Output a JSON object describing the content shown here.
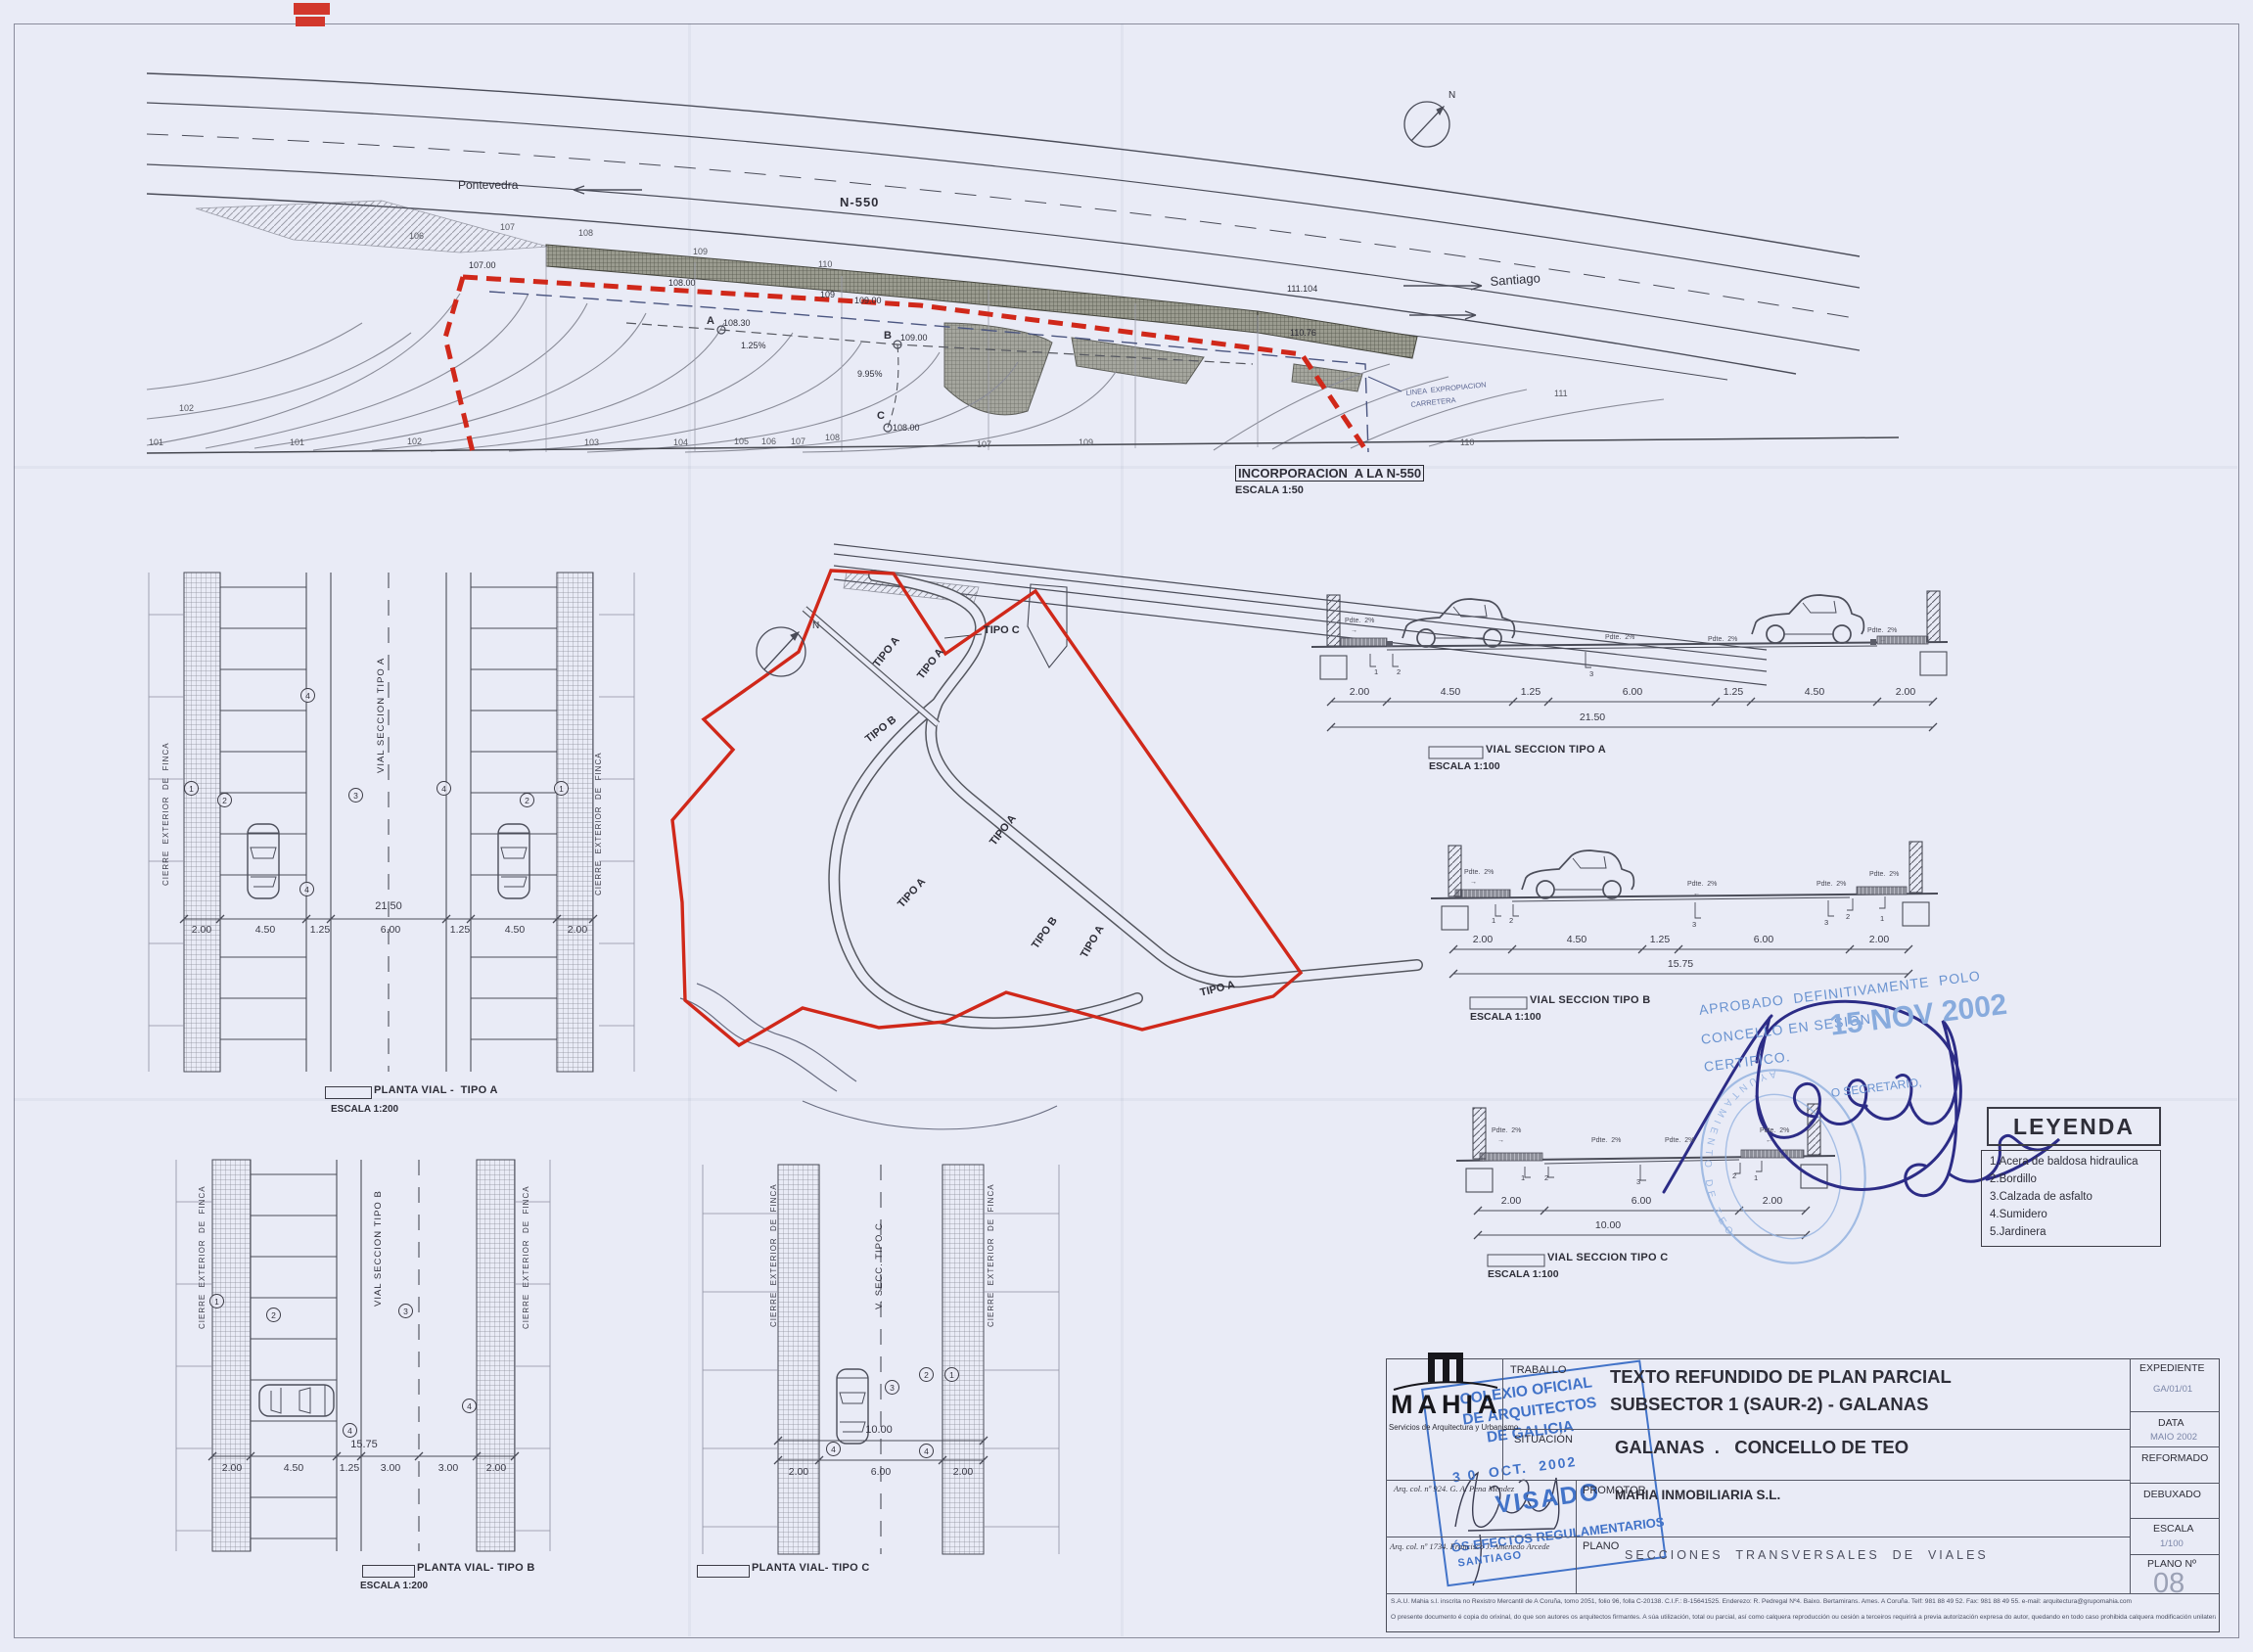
{
  "top_plan": {
    "title": "INCORPORACION  A LA N-550",
    "scale": "ESCALA 1:50",
    "dir_left": "Pontevedra",
    "dir_right": "Santiago",
    "road_name": "N-550",
    "expro_line1": "LINEA  EXPROPIACION",
    "expro_line2": "CARRETERA",
    "north": "N",
    "point_a": "A",
    "elev_a": "108.30",
    "point_b": "B",
    "elev_b": "109.00",
    "point_c": "C",
    "elev_c": "108.00",
    "slope_1": "1.25%",
    "slope_2": "9.95%",
    "spot_1": "111.104",
    "spot_2": "110.76",
    "red_elevs": [
      "107.00",
      "108.00",
      "109",
      "109.00"
    ],
    "contours_bottom": [
      "101",
      "102",
      "101",
      "102",
      "103",
      "104",
      "105",
      "106",
      "107",
      "108",
      "109",
      "107",
      "110"
    ],
    "contours_top": [
      "106",
      "107",
      "108",
      "109",
      "110",
      "111"
    ]
  },
  "site_plan": {
    "north": "N",
    "tipo_labels": [
      "TIPO C",
      "TIPO A",
      "TIPO A",
      "TIPO B",
      "TIPO A",
      "TIPO A",
      "TIPO B",
      "TIPO A",
      "TIPO A"
    ]
  },
  "plantas": {
    "fence_label": "CIERRE  EXTERIOR  DE  FINCA",
    "callouts": [
      "1",
      "2",
      "3",
      "4"
    ],
    "a": {
      "title": "PLANTA VIAL -  TIPO A",
      "scale": "ESCALA 1:200",
      "axis_label": "VIAL SECCION TIPO A",
      "dims": [
        "2.00",
        "4.50",
        "1.25",
        "6.00",
        "1.25",
        "4.50",
        "2.00"
      ],
      "total": "21.50"
    },
    "b": {
      "title": "PLANTA VIAL- TIPO B",
      "scale": "ESCALA 1:200",
      "axis_label": "VIAL SECCION TIPO B",
      "dims": [
        "2.00",
        "4.50",
        "1.25",
        "3.00",
        "3.00",
        "2.00"
      ],
      "total": "15.75"
    },
    "c": {
      "title": "PLANTA VIAL- TIPO C",
      "axis_label": "V. SECC. TIPO C",
      "dims": [
        "2.00",
        "6.00",
        "2.00"
      ],
      "total": "10.00"
    }
  },
  "sections": {
    "slope_label": "Pdte.  2%",
    "markers": [
      "1",
      "2",
      "3"
    ],
    "a": {
      "title": "VIAL SECCION TIPO A",
      "scale": "ESCALA 1:100",
      "dims": [
        "2.00",
        "4.50",
        "1.25",
        "6.00",
        "1.25",
        "4.50",
        "2.00"
      ],
      "total": "21.50"
    },
    "b": {
      "title": "VIAL SECCION TIPO B",
      "scale": "ESCALA 1:100",
      "dims": [
        "2.00",
        "4.50",
        "1.25",
        "6.00",
        "2.00"
      ],
      "total": "15.75"
    },
    "c": {
      "title": "VIAL SECCION TIPO C",
      "scale": "ESCALA 1:100",
      "dims": [
        "2.00",
        "6.00",
        "2.00"
      ],
      "total": "10.00"
    }
  },
  "legend": {
    "title": "LEYENDA",
    "items": [
      "1.Acera de baldosa hidraulica",
      "2.Bordillo",
      "3.Calzada de asfalto",
      "4.Sumidero",
      "5.Jardinera"
    ]
  },
  "stamps": {
    "approval": {
      "line1": "APROBADO  DEFINITIVAMENTE  POLO",
      "line2": "CONCELLO EN SESIÓN",
      "date": "15 NOV 2002",
      "line3": "CERTIFICO.",
      "line4": "O SECRETARIO,",
      "round_text": "AYUNTAMIENTO  DE  TEO"
    },
    "visado": {
      "line1": "COLEXIO OFICIAL",
      "line2": "DE ARQUITECTOS",
      "line3": "DE GALICIA",
      "date": "3 0  OCT.  2002",
      "word": "VISADO",
      "city": "SANTIAGO",
      "footer": "ÓS EFECTOS REGULAMENTARIOS"
    }
  },
  "title_block": {
    "logo": "MAHIA",
    "logo_sub": "Servicios de Arquitectura y Urbanismo",
    "arch1": "Arq. col. nº 924. G. A. Pena Mendez",
    "arch2": "Arq. col. nº 1734. Francisco J. Amenedo Arcede",
    "traballo_label": "TRABALLO",
    "traballo_line1": "TEXTO REFUNDIDO DE PLAN PARCIAL",
    "traballo_line2": "SUBSECTOR 1 (SAUR-2) - GALANAS",
    "situacion_label": "SITUACIÓN",
    "situacion_value": "GALANAS  .   CONCELLO DE TEO",
    "promotor_label": "PROMOTOR",
    "promotor_value": "MAHIA INMOBILIARIA S.L.",
    "plano_label": "PLANO",
    "plano_value": "SECCIONES  TRANSVERSALES  DE  VIALES",
    "expediente_label": "EXPEDIENTE",
    "expediente_value": "GA/01/01",
    "data_label": "DATA",
    "data_value": "MAIO 2002",
    "reformado_label": "REFORMADO",
    "debuxado_label": "DEBUXADO",
    "escala_label": "ESCALA",
    "escala_value": "1/100",
    "plano_n_label": "PLANO Nº",
    "plano_n_value": "08",
    "legal1": "S.A.U. Mahia s.l. inscrita no Rexistro Mercantil de A Coruña, tomo 2051, folio 96, folla C-20138. C.I.F.: B-15641525. Enderezo: R. Pedregal Nº4. Baixo. Bertamirans. Ames. A Coruña. Telf: 981 88 49 52. Fax: 981 88 49 55. e-mail: arquitectura@grupomahia.com",
    "legal2": "O presente documento é copia do orixinal, do que son autores os arquitectos firmantes. A súa utilización, total ou parcial, así como calquera reproducción ou cesión a terceiros requirirá a previa autorización expresa do autor, quedando en todo caso prohibida calquera modificación unilateral do mesmo"
  },
  "misc": {
    "arrow_right": "→",
    "arrow_left": "←"
  }
}
